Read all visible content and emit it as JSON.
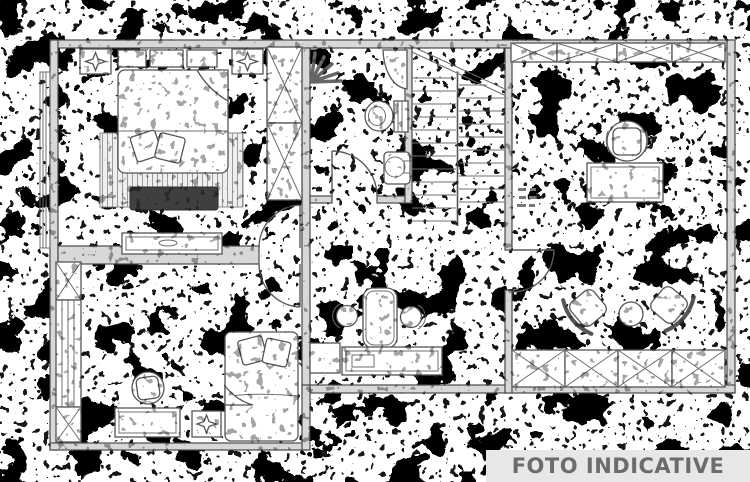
{
  "banner": {
    "text": "FOTO INDICATIVE",
    "background": "#e7e7e7",
    "color": "#6c6c6c"
  },
  "palette": {
    "paper": "#ffffff",
    "wall_fill": "#d8d8d8",
    "wall_edge": "#4a4a4a",
    "furniture_line": "#555555",
    "noise": "#000000",
    "bench_dark": "#3f3f3f"
  },
  "plan": {
    "type": "apartment-floor-plan",
    "style": "degraded-noisy-scan",
    "rooms": [
      {
        "name": "bedroom-top-left",
        "features": [
          "double-bed",
          "decorative-pillows",
          "hatched-rug",
          "dark-bench",
          "dresser",
          "tall-wardrobe-2-cells",
          "wall-shelves",
          "ceiling-symbol",
          "radiator-strip"
        ]
      },
      {
        "name": "bathroom-center-top",
        "features": [
          "shower-spray",
          "corner-basin",
          "toilet",
          "round-washbasin",
          "door-swing"
        ]
      },
      {
        "name": "staircase-center",
        "features": [
          "two-flights",
          "central-stringer",
          "diagonal-break-line"
        ]
      },
      {
        "name": "bedroom-bottom-left",
        "features": [
          "single-bed",
          "pillows",
          "desk",
          "desk-chair",
          "wardrobe-column",
          "ceiling-symbol",
          "door-swing"
        ]
      },
      {
        "name": "hallway-kitchenette",
        "features": [
          "high-table",
          "two-round-stools",
          "counter",
          "small-cabinet"
        ]
      },
      {
        "name": "living-room-right",
        "features": [
          "wardrobe-row-top-4-cells",
          "office-chair",
          "desk",
          "illegible-room-label",
          "two-armchairs",
          "round-table",
          "wardrobe-row-bottom-4-cells",
          "door-swing"
        ]
      }
    ]
  }
}
